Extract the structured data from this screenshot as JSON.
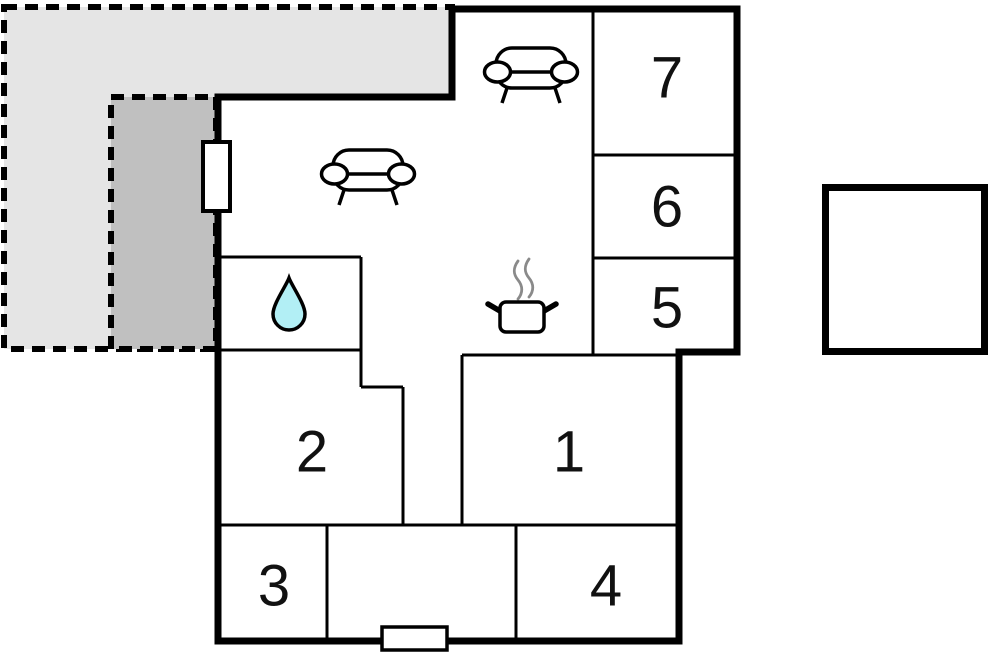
{
  "floor_plan": {
    "rooms": [
      {
        "label": "1"
      },
      {
        "label": "2"
      },
      {
        "label": "3"
      },
      {
        "label": "4"
      },
      {
        "label": "5"
      },
      {
        "label": "6"
      },
      {
        "label": "7"
      }
    ],
    "icons": [
      {
        "name": "sofa-icon",
        "location": "living-area-top"
      },
      {
        "name": "sofa-icon",
        "location": "living-area-left"
      },
      {
        "name": "cooking-pot-icon",
        "location": "kitchen-area"
      },
      {
        "name": "steam-icon",
        "location": "kitchen-area"
      },
      {
        "name": "water-drop-icon",
        "location": "bathroom"
      }
    ],
    "markers": [
      {
        "name": "window-marker",
        "location": "left-wall"
      },
      {
        "name": "entrance-door-marker",
        "location": "bottom-wall"
      }
    ],
    "outdoor_areas": [
      {
        "name": "terrace-light"
      },
      {
        "name": "terrace-dark"
      }
    ],
    "annex": {
      "name": "detached-square-building"
    }
  },
  "colors": {
    "wall": "#000000",
    "room_fill": "#ffffff",
    "terrace_light": "#e5e5e5",
    "terrace_dark": "#c0c0c0",
    "water_drop": "#b2eff5",
    "steam": "#8a8a8a",
    "label_text": "#111111"
  }
}
